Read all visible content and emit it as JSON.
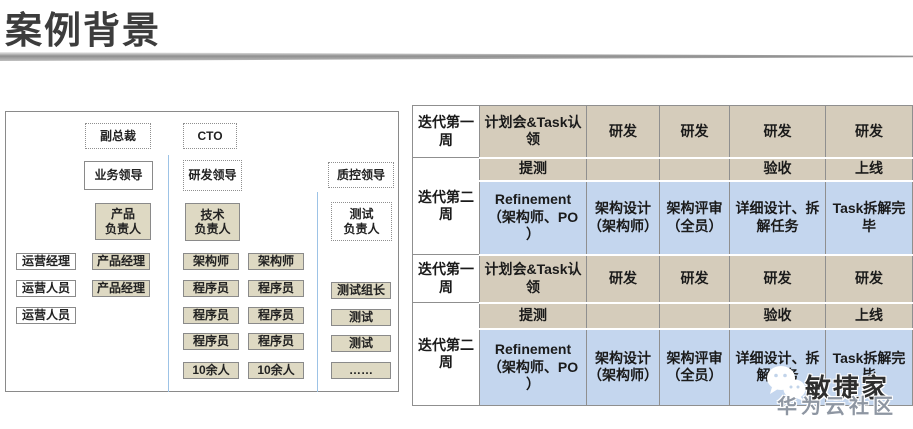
{
  "title": "案例背景",
  "colors": {
    "table_tan": "#d5ccbb",
    "table_blue": "#c4d6ee",
    "org_box_tan": "#ded9c3",
    "divider_gray": "#8f8f8f",
    "section_line_blue": "#9dc3e6"
  },
  "org_chart": {
    "business": {
      "executive": "副总裁",
      "leader": "业务领导",
      "owner": "产品\n负责人",
      "operations": [
        "运营经理",
        "运营人员",
        "运营人员"
      ],
      "product_managers": [
        "产品经理",
        "产品经理"
      ]
    },
    "rnd": {
      "executive": "CTO",
      "leader": "研发领导",
      "owner": "技术\n负责人",
      "team_a": [
        "架构师",
        "程序员",
        "程序员",
        "程序员",
        "10余人"
      ],
      "team_b": [
        "架构师",
        "程序员",
        "程序员",
        "程序员",
        "10余人"
      ]
    },
    "qa": {
      "leader": "质控领导",
      "owner": "测试\n负责人",
      "team": [
        "测试组长",
        "测试",
        "测试",
        "……"
      ]
    }
  },
  "table": {
    "week_headers": [
      "迭代第一\n周",
      "迭代第二\n周",
      "迭代第一\n周",
      "迭代第二\n周"
    ],
    "rows": [
      {
        "cells": [
          "计划会&Task认\n领",
          "研发",
          "研发",
          "研发",
          "研发"
        ]
      },
      {
        "cells": [
          "提测",
          "",
          "",
          "验收",
          "上线"
        ]
      },
      {
        "cells": [
          "Refinement\n（架构师、PO\n）",
          "架构设计\n（架构师）",
          "架构评审\n（全员）",
          "详细设计、拆\n解任务",
          "Task拆解完\n毕"
        ]
      },
      {
        "cells": [
          "计划会&Task认\n领",
          "研发",
          "研发",
          "研发",
          "研发"
        ]
      },
      {
        "cells": [
          "提测",
          "",
          "",
          "验收",
          "上线"
        ]
      },
      {
        "cells": [
          "Refinement\n（架构师、PO\n）",
          "架构设计\n（架构师）",
          "架构评审\n（全员）",
          "详细设计、拆\n解任务",
          "Task拆解完\n毕"
        ]
      }
    ]
  },
  "watermark": {
    "icon": "wechat-icon",
    "brand": "敏捷家",
    "community": "华为云社区"
  }
}
